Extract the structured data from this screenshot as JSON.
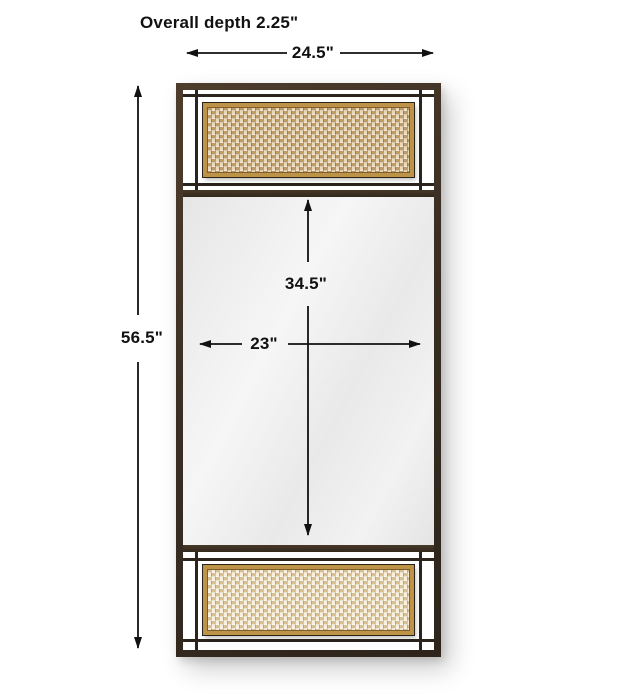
{
  "diagram": {
    "overall_depth_label": "Overall depth 2.25\"",
    "width_label": "24.5\"",
    "height_label": "56.5\"",
    "mirror_height_label": "34.5\"",
    "mirror_width_label": "23\""
  },
  "colors": {
    "frame_bronze": "#3a2e24",
    "grid_bar": "#2b241d",
    "gold_trim": "#bd9347",
    "cane_top": "#cdad7d",
    "cane_top_alt": "#e7d9b9",
    "cane_bottom": "#ead9b6",
    "cane_bottom_alt": "#f6efdf",
    "mirror_surface": "#ededed",
    "dimension_line": "#111111",
    "background": "#ffffff"
  }
}
